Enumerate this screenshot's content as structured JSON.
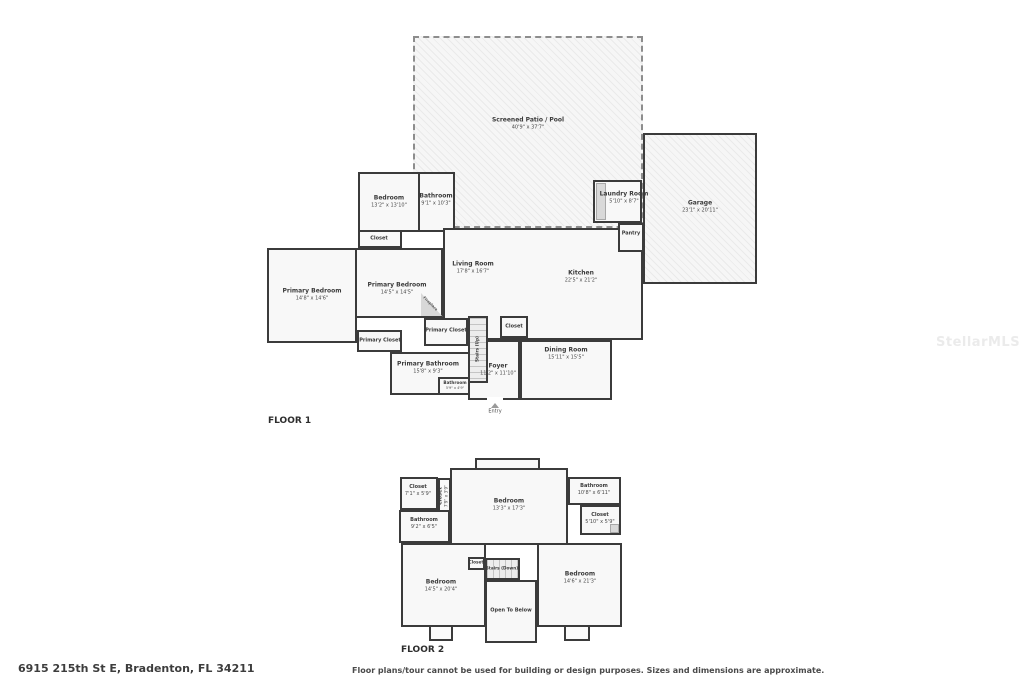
{
  "watermark": "StellarMLS",
  "colors": {
    "wall": "#3b3b3b",
    "room_fill": "#f7f7f7",
    "watermark": "#ebebeb"
  },
  "footer": {
    "address": "6915 215th St E, Bradenton, FL 34211",
    "disclaimer": "Floor plans/tour cannot be used for building or design purposes. Sizes and dimensions are approximate."
  },
  "floor1": {
    "label": "FLOOR 1",
    "rooms": {
      "patio": {
        "name": "Screened Patio / Pool",
        "dims": "40'9\" x 37'7\""
      },
      "garage": {
        "name": "Garage",
        "dims": "23'1\" x 20'11\""
      },
      "bedroom": {
        "name": "Bedroom",
        "dims": "13'2\" x 13'10\""
      },
      "bathroom": {
        "name": "Bathroom",
        "dims": "9'1\" x 10'3\""
      },
      "closet_bedroom": {
        "name": "Closet"
      },
      "primary_bedroom_left": {
        "name": "Primary Bedroom",
        "dims": "14'8\" x 14'6\""
      },
      "primary_bedroom_center": {
        "name": "Primary Bedroom",
        "dims": "14'5\" x 14'5\""
      },
      "living_room": {
        "name": "Living Room",
        "dims": "17'8\" x 16'7\""
      },
      "kitchen": {
        "name": "Kitchen",
        "dims": "22'5\" x 21'2\""
      },
      "dining_room": {
        "name": "Dining Room",
        "dims": "15'11\" x 15'5\""
      },
      "foyer": {
        "name": "Foyer",
        "dims": "11'2\" x 11'10\""
      },
      "primary_bathroom": {
        "name": "Primary Bathroom",
        "dims": "15'8\" x 9'3\""
      },
      "bathroom_small": {
        "name": "Bathroom",
        "dims": "5'9\" x 4'9\""
      },
      "primary_closet_left": {
        "name": "Primary Closet"
      },
      "primary_closet_right": {
        "name": "Primary Closet"
      },
      "closet_hall": {
        "name": "Closet"
      },
      "stairs_up": {
        "name": "Stairs (Up)"
      },
      "fireplace": {
        "name": "Fireplace"
      },
      "laundry": {
        "name": "Laundry Room",
        "dims": "5'10\" x 8'7\""
      },
      "pantry": {
        "name": "Pantry"
      },
      "entry": {
        "name": "Entry"
      }
    }
  },
  "floor2": {
    "label": "FLOOR 2",
    "rooms": {
      "closet_tl": {
        "name": "Closet",
        "dims": "7'1\" x 5'9\""
      },
      "closet_vert": {
        "name": "Closet",
        "dims": "7'9\" x 3'9\""
      },
      "bathroom_left": {
        "name": "Bathroom",
        "dims": "9'2\" x 6'5\""
      },
      "bedroom_top": {
        "name": "Bedroom",
        "dims": "13'3\" x 17'3\""
      },
      "bathroom_right": {
        "name": "Bathroom",
        "dims": "10'8\" x 6'11\""
      },
      "closet_right": {
        "name": "Closet",
        "dims": "5'10\" x 5'9\""
      },
      "bedroom_left": {
        "name": "Bedroom",
        "dims": "14'5\" x 20'4\""
      },
      "closet_stairs": {
        "name": "Closet"
      },
      "stairs_down": {
        "name": "Stairs (Down)"
      },
      "open_below": {
        "name": "Open To Below"
      },
      "bedroom_right": {
        "name": "Bedroom",
        "dims": "14'6\" x 21'3\""
      }
    }
  }
}
